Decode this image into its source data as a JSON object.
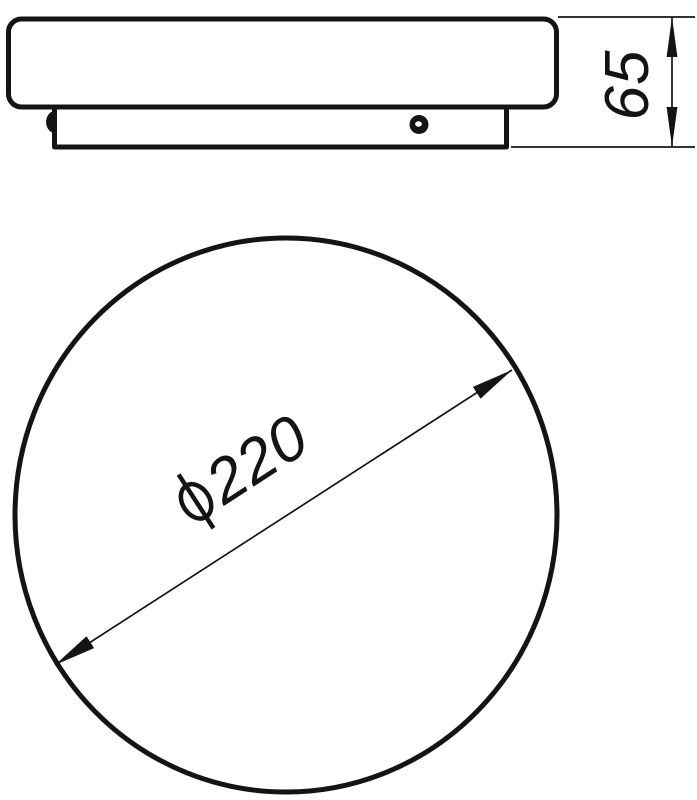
{
  "page": {
    "background_color": "#ffffff",
    "line_color": "#141414",
    "description": "Technical dimension drawing of a round ceiling lamp: side elevation and plan view"
  },
  "side_view": {
    "height_dimension": {
      "value": "65"
    }
  },
  "top_view": {
    "diameter_dimension": {
      "symbol": "⌀",
      "value": "220",
      "full_label": "⌀220"
    }
  }
}
